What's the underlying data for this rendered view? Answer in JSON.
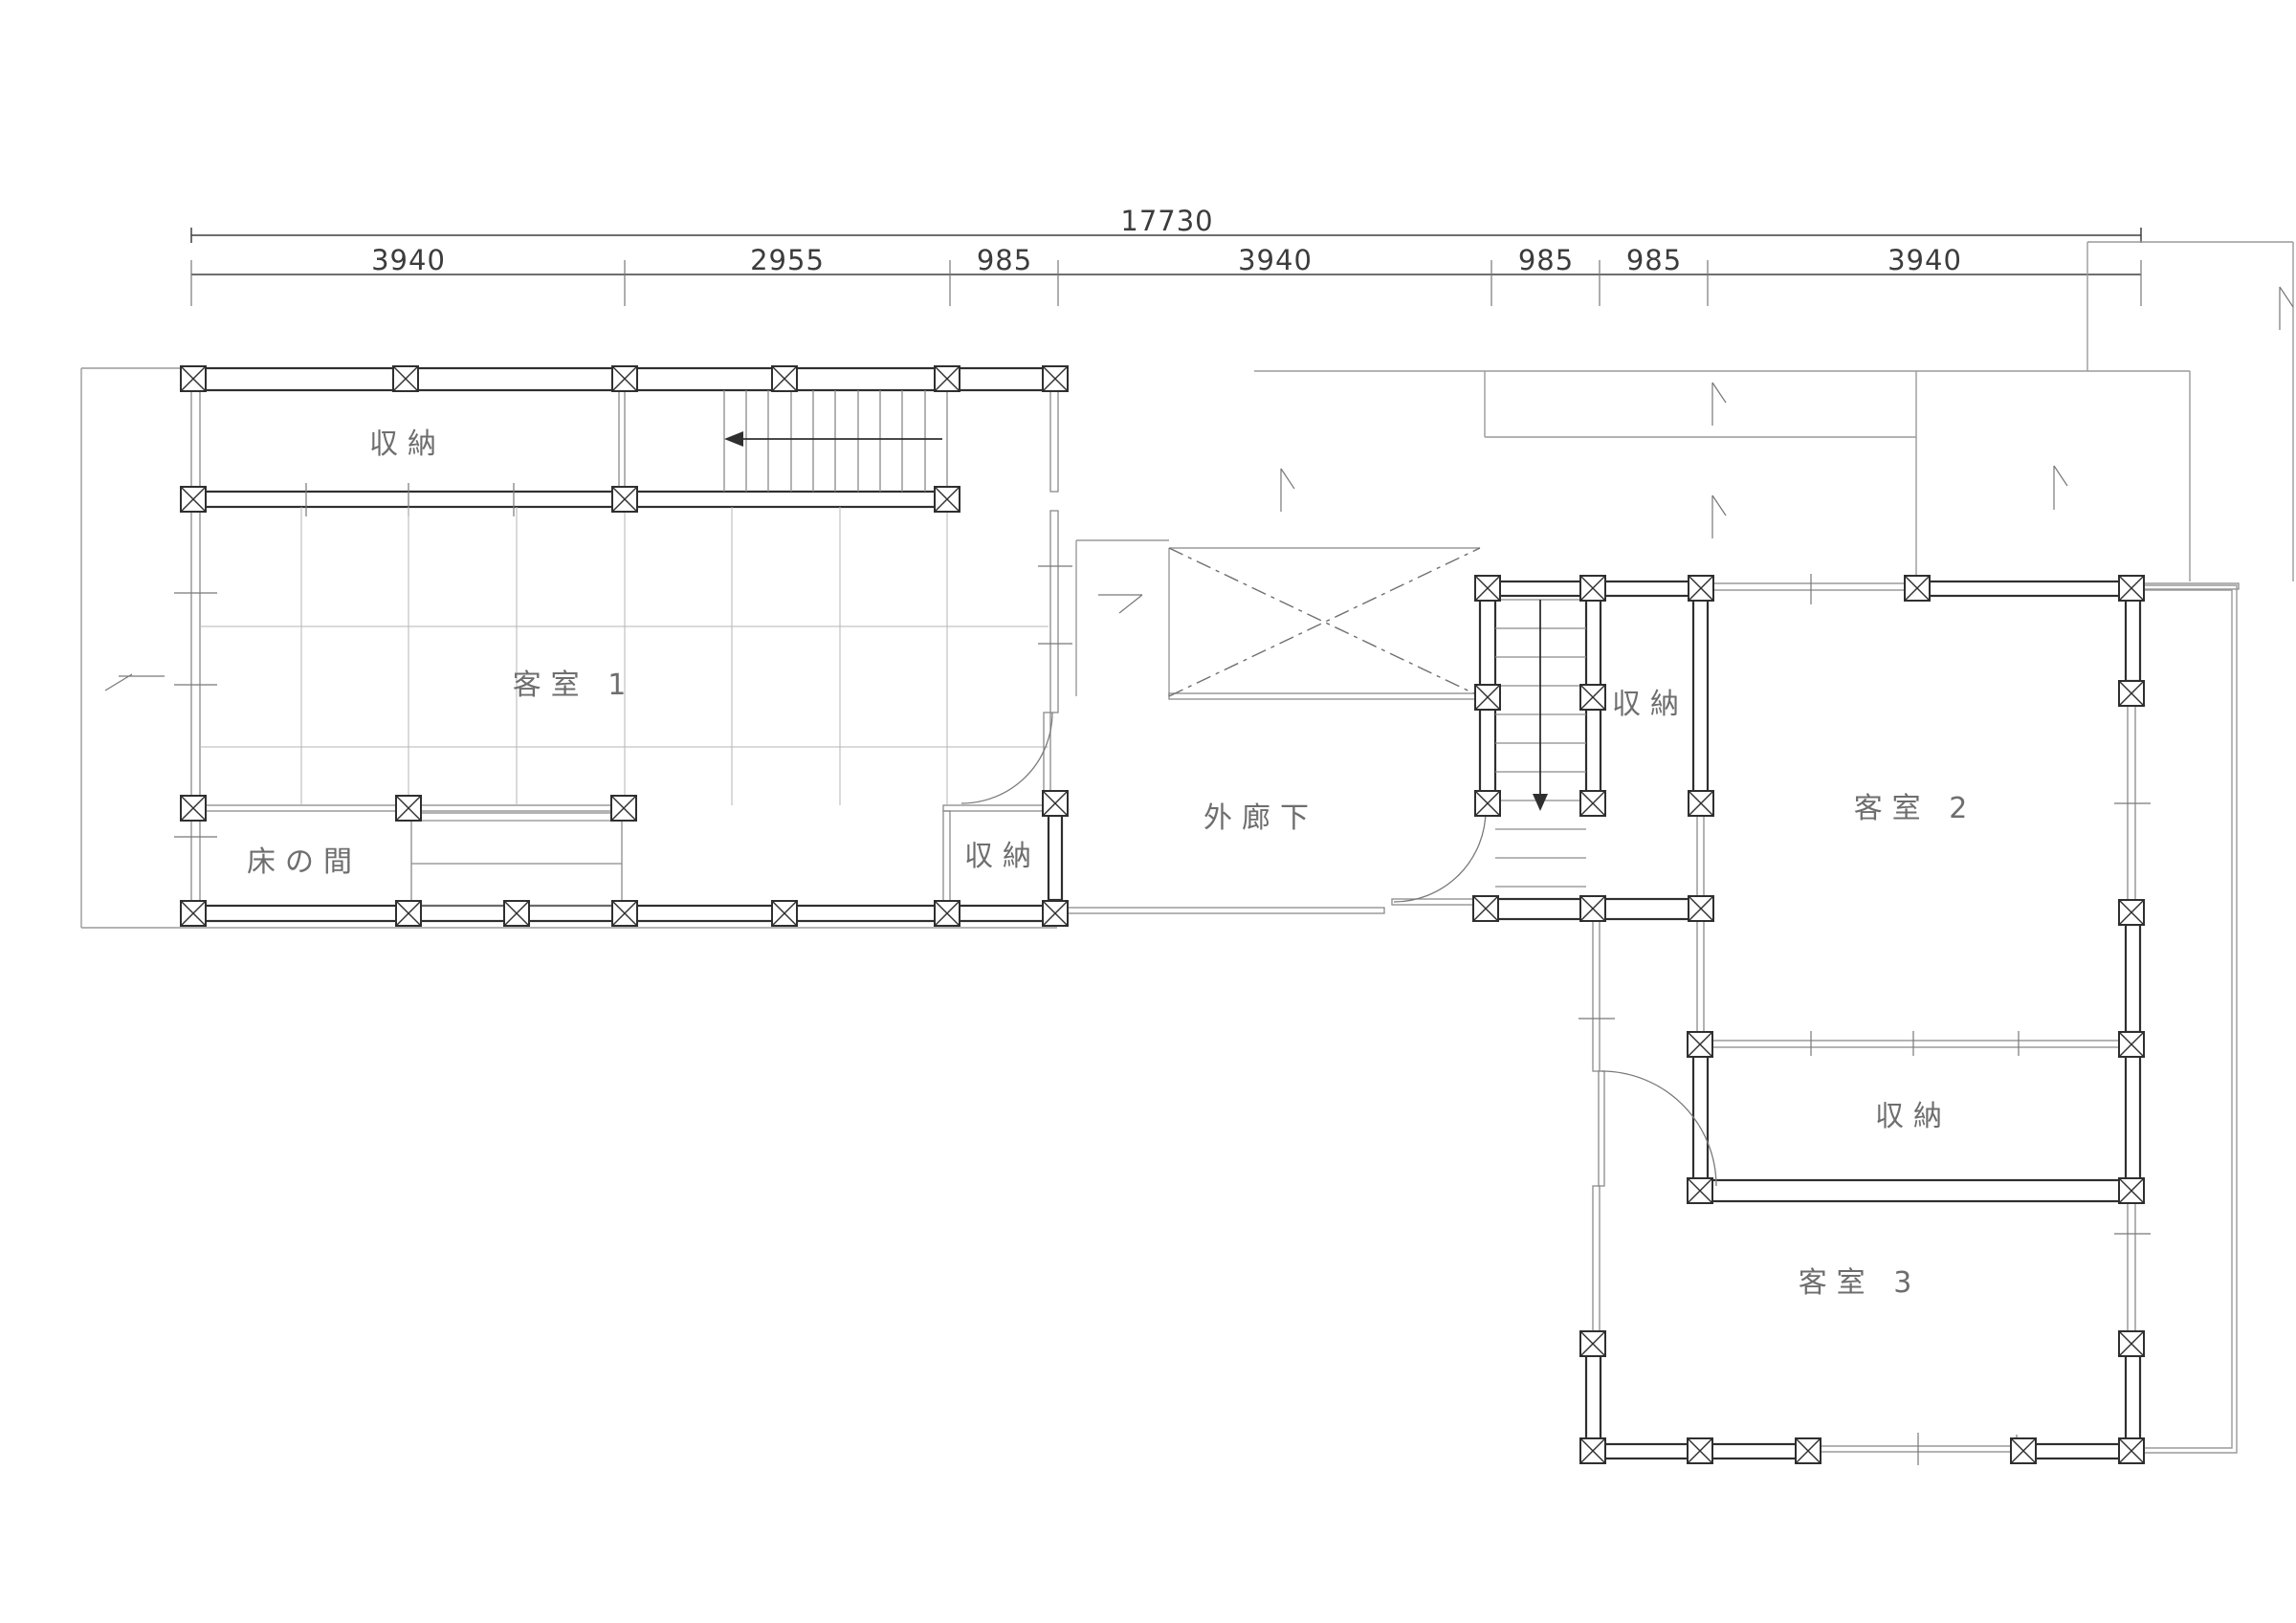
{
  "drawing_type": "floor-plan",
  "dimensions": {
    "total": "17730",
    "segments": [
      "3940",
      "2955",
      "985",
      "3940",
      "985",
      "985",
      "3940"
    ]
  },
  "rooms": [
    {
      "name": "storage-top-left",
      "label": "収納"
    },
    {
      "name": "guest-room-1",
      "label": "客室 1"
    },
    {
      "name": "tokonoma",
      "label": "床の間"
    },
    {
      "name": "storage-guest1-side",
      "label": "収納"
    },
    {
      "name": "outer-corridor",
      "label": "外廊下"
    },
    {
      "name": "storage-by-stairs",
      "label": "収納"
    },
    {
      "name": "guest-room-2",
      "label": "客室 2"
    },
    {
      "name": "storage-guest2-side",
      "label": "収納"
    },
    {
      "name": "guest-room-3",
      "label": "客室 3"
    }
  ],
  "colors": {
    "background": "#ffffff",
    "wall_line": "#2f2f2f",
    "thin_line": "#8a8a8a",
    "tatami_line": "#b5b5b5",
    "label_text": "#6e6e6e",
    "dimension_text": "#3c3c3c"
  }
}
